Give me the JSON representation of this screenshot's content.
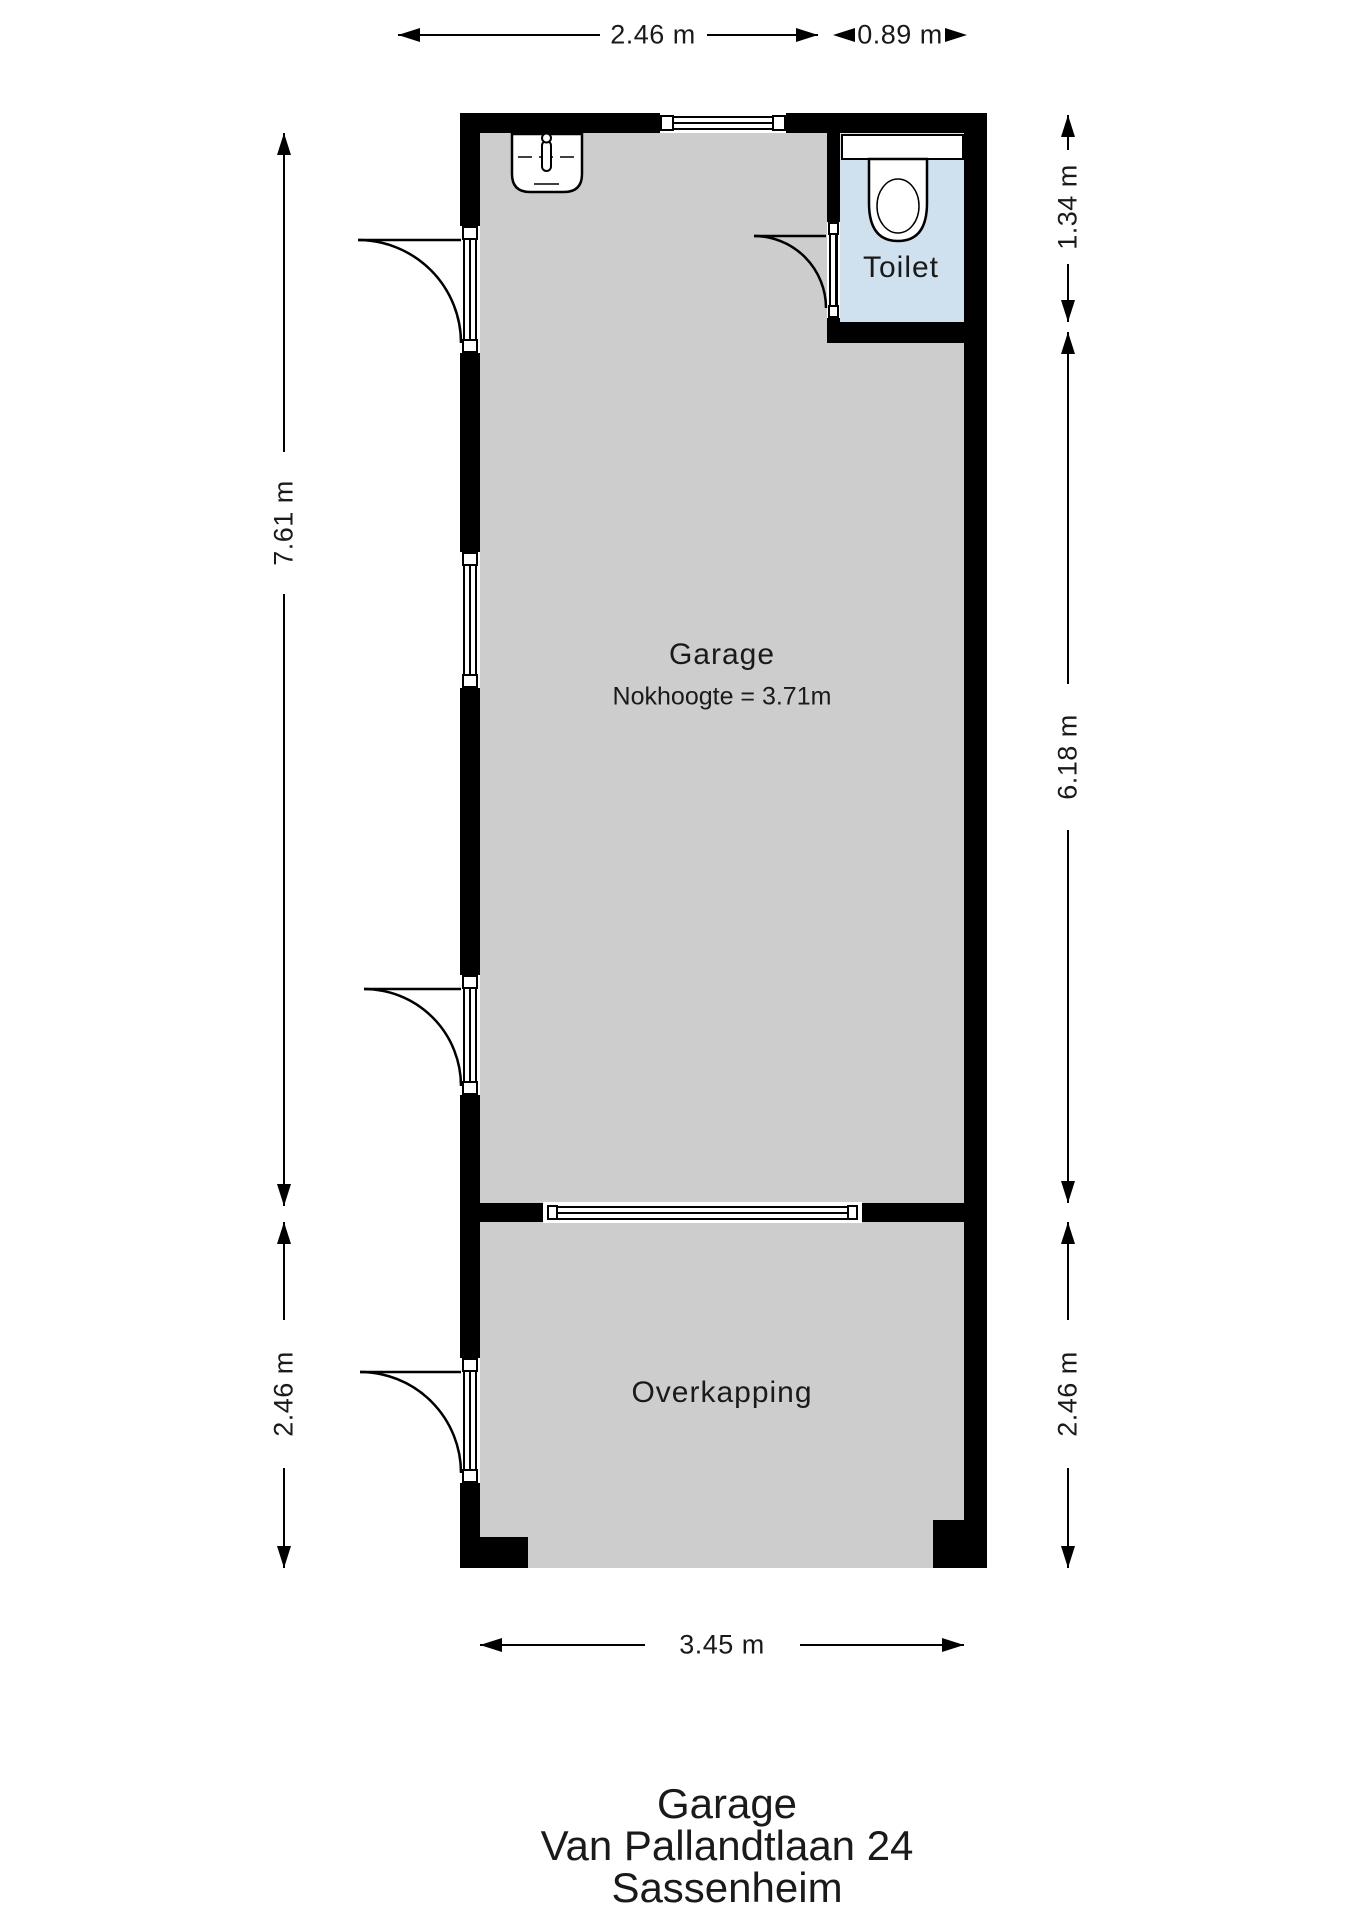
{
  "plan": {
    "type": "floorplan",
    "colors": {
      "wall": "#000000",
      "floor": "#cdcdcd",
      "toilet_floor": "#cfe0ef",
      "background": "#ffffff"
    },
    "rooms": {
      "garage": {
        "label": "Garage",
        "note": "Nokhoogte = 3.71m"
      },
      "toilet": {
        "label": "Toilet"
      },
      "overkapping": {
        "label": "Overkapping"
      }
    },
    "dimensions": {
      "top_garage": "2.46 m",
      "top_toilet": "0.89 m",
      "left_garage": "7.61 m",
      "left_overkapping": "2.46 m",
      "right_toilet": "1.34 m",
      "right_garage": "6.18 m",
      "right_overkapping": "2.46 m",
      "bottom_overkapping": "3.45 m"
    },
    "fixtures": {
      "sink": "sink-icon",
      "toilet": "toilet-icon"
    },
    "title": {
      "line1": "Garage",
      "line2": "Van Pallandtlaan 24",
      "line3": "Sassenheim"
    }
  }
}
